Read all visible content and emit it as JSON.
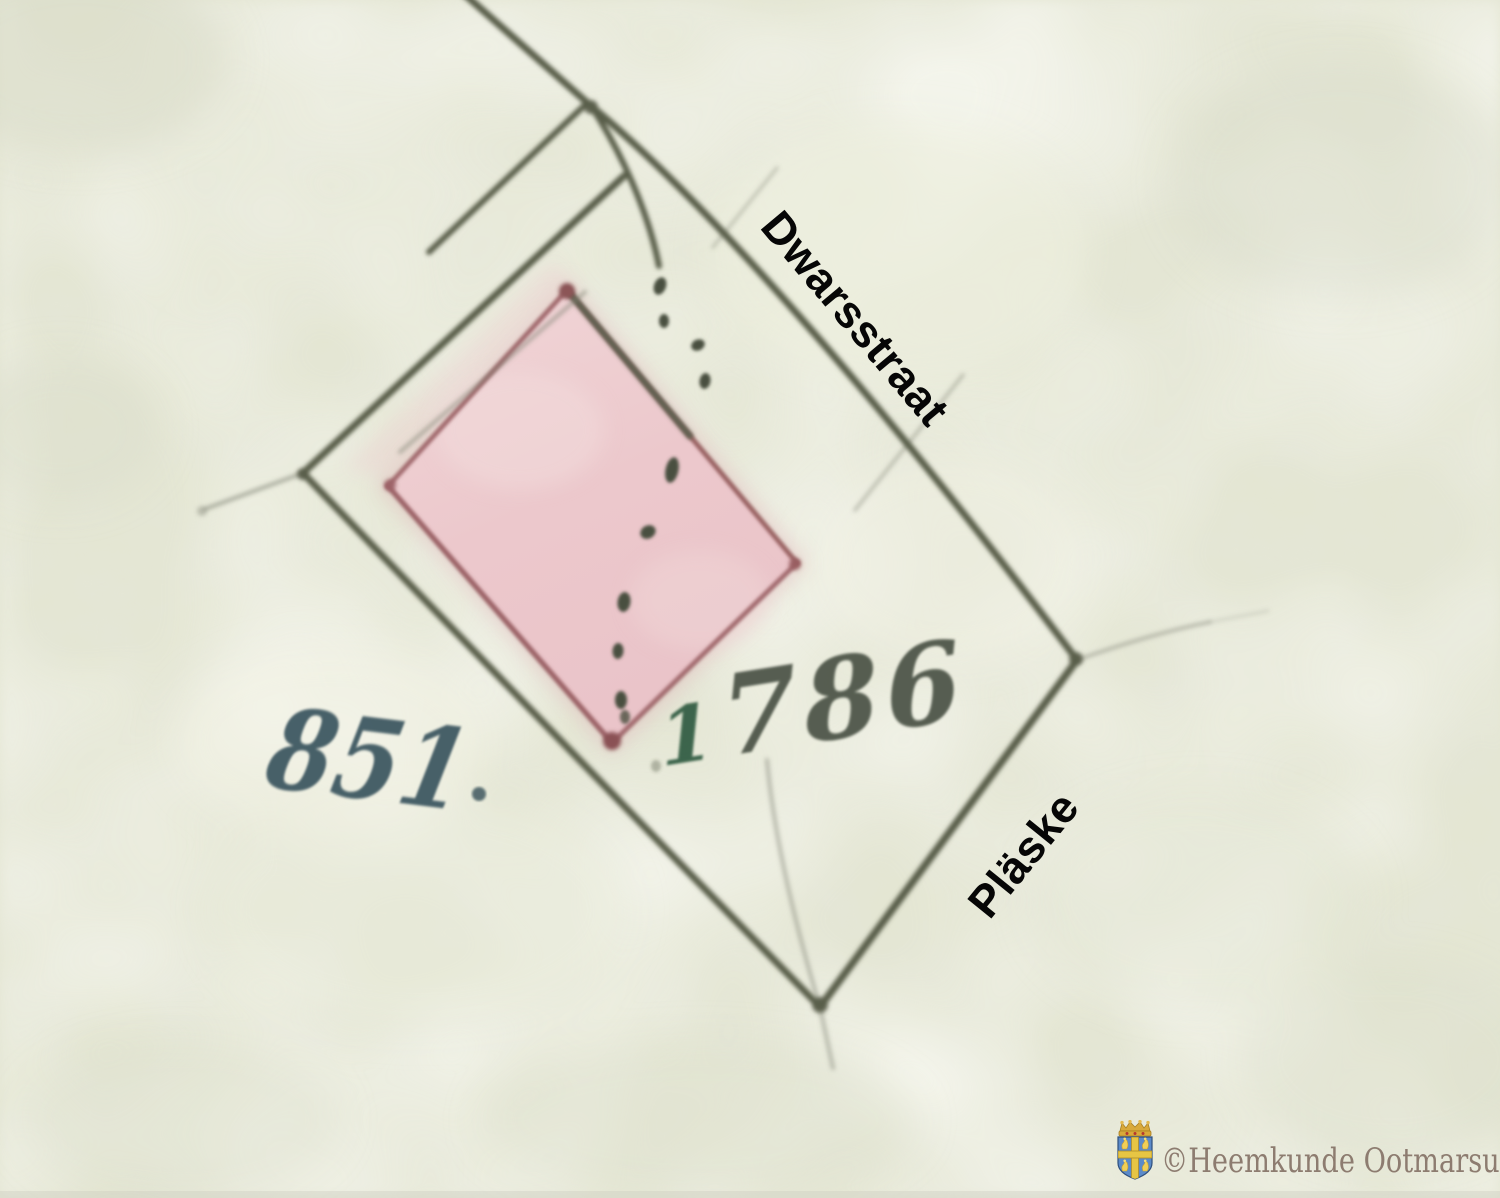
{
  "map": {
    "street_label": "Dwarsstraat",
    "area_label": "Pläske",
    "parcel_left_number": "851",
    "parcel_right_number": "1786",
    "parcel_right_number_prefix": "1",
    "parcel_right_number_rest": "786",
    "colors": {
      "paper": "#e4e6d3",
      "boundary_line": "#595d4a",
      "building_fill": "#ecc9cd",
      "building_outline": "#9d6165",
      "number_blue": "#3b555f",
      "number_green": "#2f5a41",
      "number_dark": "#4a5145",
      "label_text": "#060606",
      "watermark_text": "#8d7c70",
      "shield_blue": "#5b8ac9",
      "shield_gold": "#e7c544"
    }
  },
  "watermark": {
    "text": "©Heemkunde Ootmarsum",
    "icon": "ootmarsum-coat-of-arms"
  }
}
